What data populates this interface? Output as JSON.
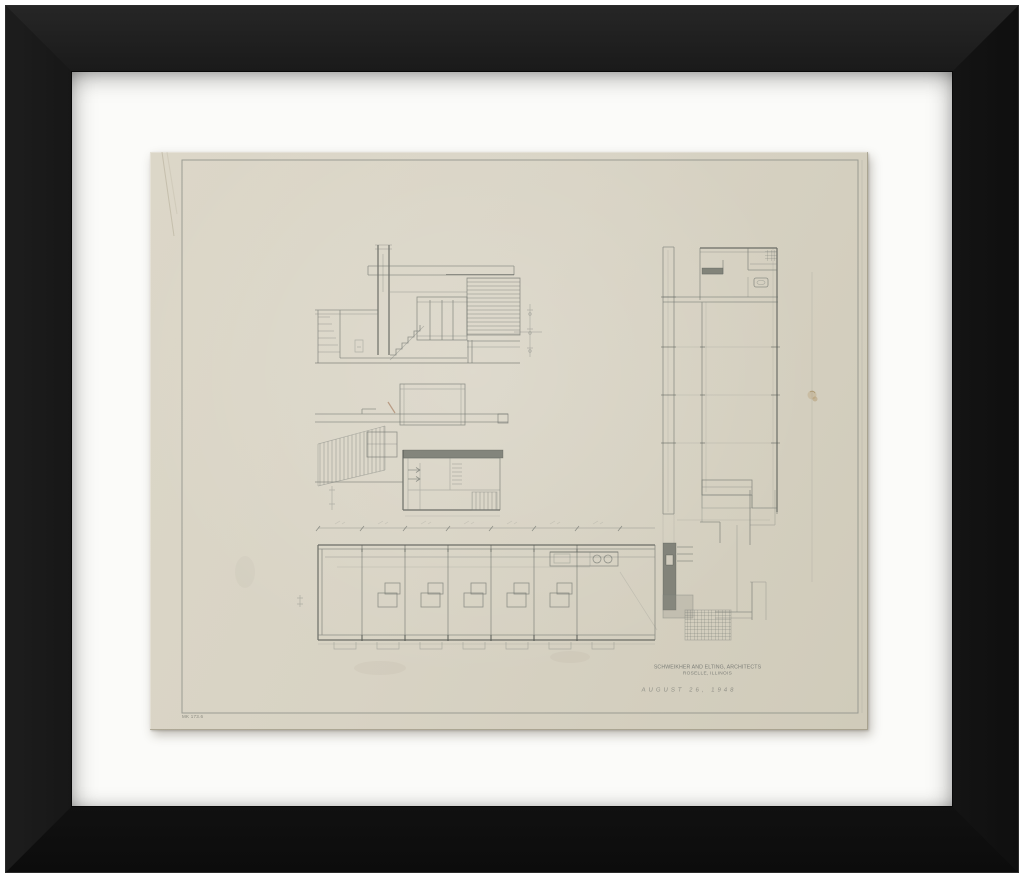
{
  "artwork": {
    "frame_color": "#161616",
    "mat_color": "#fbfbf9",
    "paper_color": "#d8d3c4",
    "pencil_color": "#6f736e",
    "stamp_color": "#686c68"
  },
  "title_block": {
    "firm": "SCHWEIKHER AND ELTING, ARCHITECTS",
    "location": "ROSELLE, ILLINOIS",
    "date": "AUGUST 26, 1948"
  },
  "margin_note": "MK 173.6"
}
